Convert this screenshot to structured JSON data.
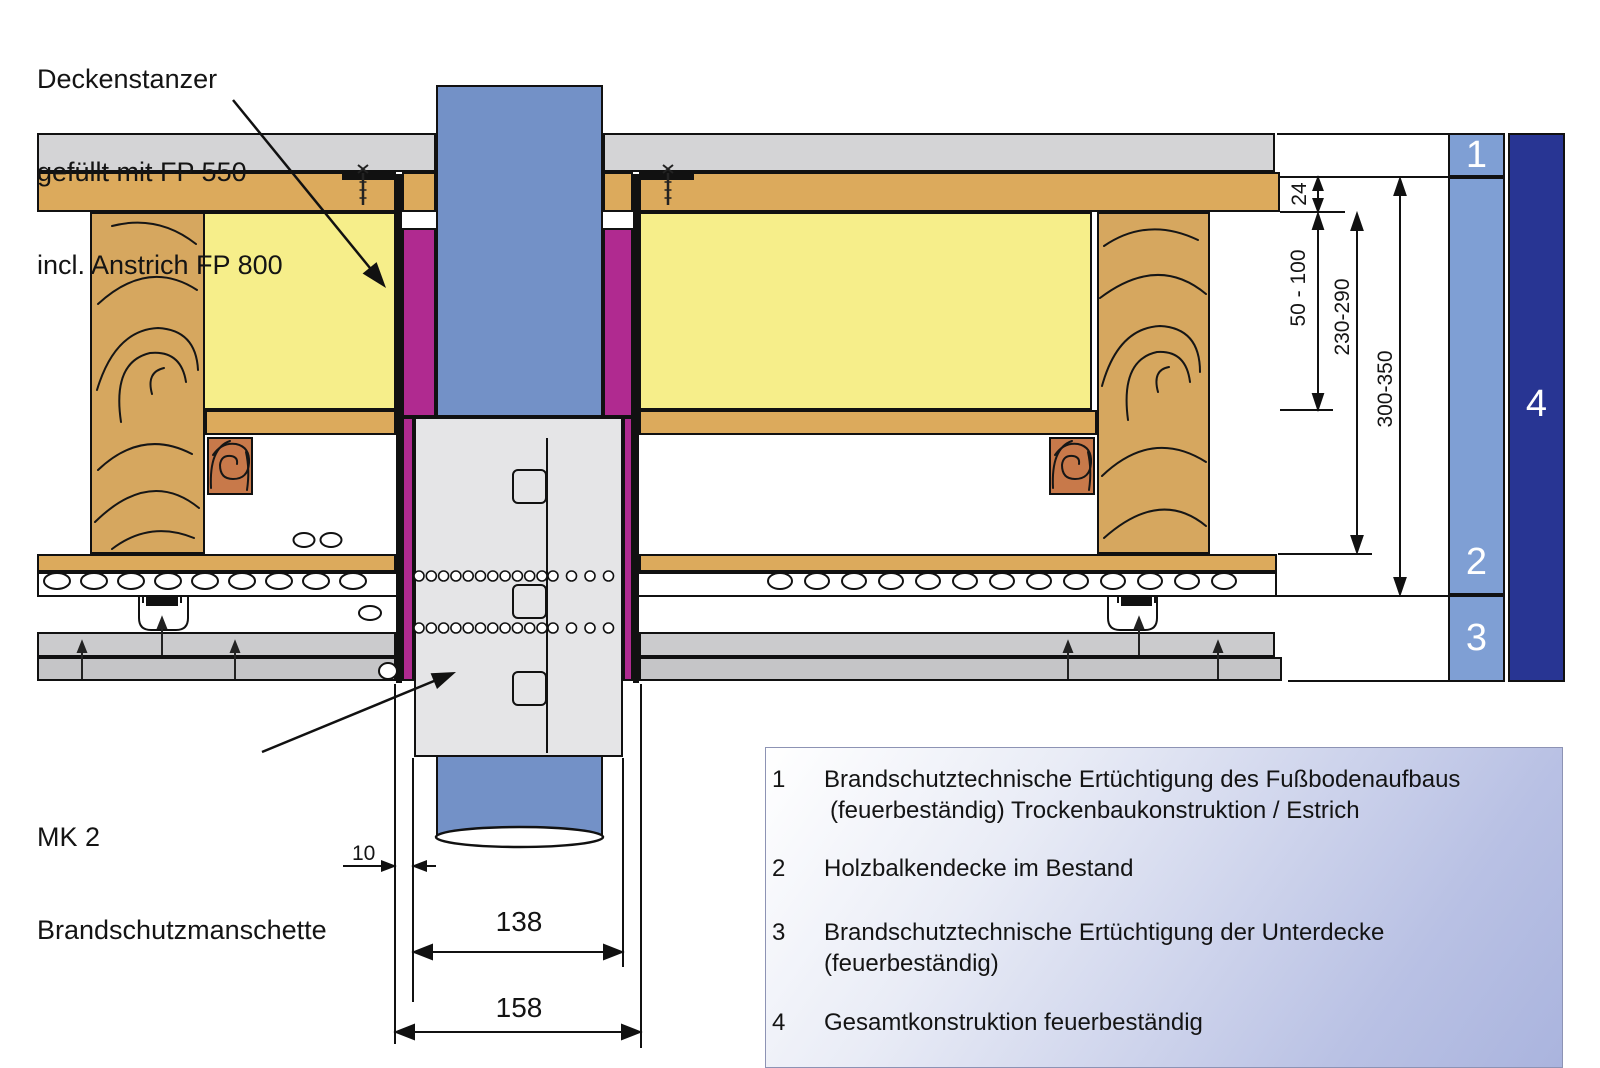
{
  "annotations": {
    "deckenstanzer": {
      "line1": "Deckenstanzer",
      "line2": "gefüllt mit FP 550",
      "line3": "incl. Anstrich FP 800"
    },
    "manschette": {
      "line1": "MK 2",
      "line2": "Brandschutzmanschette"
    }
  },
  "dimensions": {
    "gap": "10",
    "collar_width": "138",
    "outer_width": "158",
    "board_thickness": "24",
    "insulation_depth": "50 - 100",
    "beam_height": "230-290",
    "total_height": "300-350"
  },
  "markers": {
    "m1": "1",
    "m2": "2",
    "m3": "3",
    "m4": "4"
  },
  "legend": {
    "items": [
      {
        "num": "1",
        "line1": "Brandschutztechnische Ertüchtigung des Fußbodenaufbaus",
        "line2": "(feuerbeständig) Trockenbaukonstruktion / Estrich"
      },
      {
        "num": "2",
        "line1": "Holzbalkendecke im Bestand",
        "line2": ""
      },
      {
        "num": "3",
        "line1": "Brandschutztechnische Ertüchtigung  der Unterdecke",
        "line2": "(feuerbeständig)"
      },
      {
        "num": "4",
        "line1": "Gesamtkonstruktion feuerbeständig",
        "line2": ""
      }
    ]
  },
  "palette": {
    "screed": "#d4d4d6",
    "wood_board": "#dcaa5c",
    "beam": "#d6a75f",
    "insulation": "#f6ee8a",
    "batten_block": "#c8794a",
    "fire_fill_magenta": "#b02a90",
    "pipe_blue": "#7391c7",
    "collar_gray": "#e5e5e7",
    "plasterboard1": "#cbcbcd",
    "plasterboard2": "#c5c5c7",
    "marker_light_blue": "#7f9fd4",
    "marker_dark_blue": "#283593",
    "legend_gradient_end": "#aab4de",
    "line": "#111111"
  }
}
